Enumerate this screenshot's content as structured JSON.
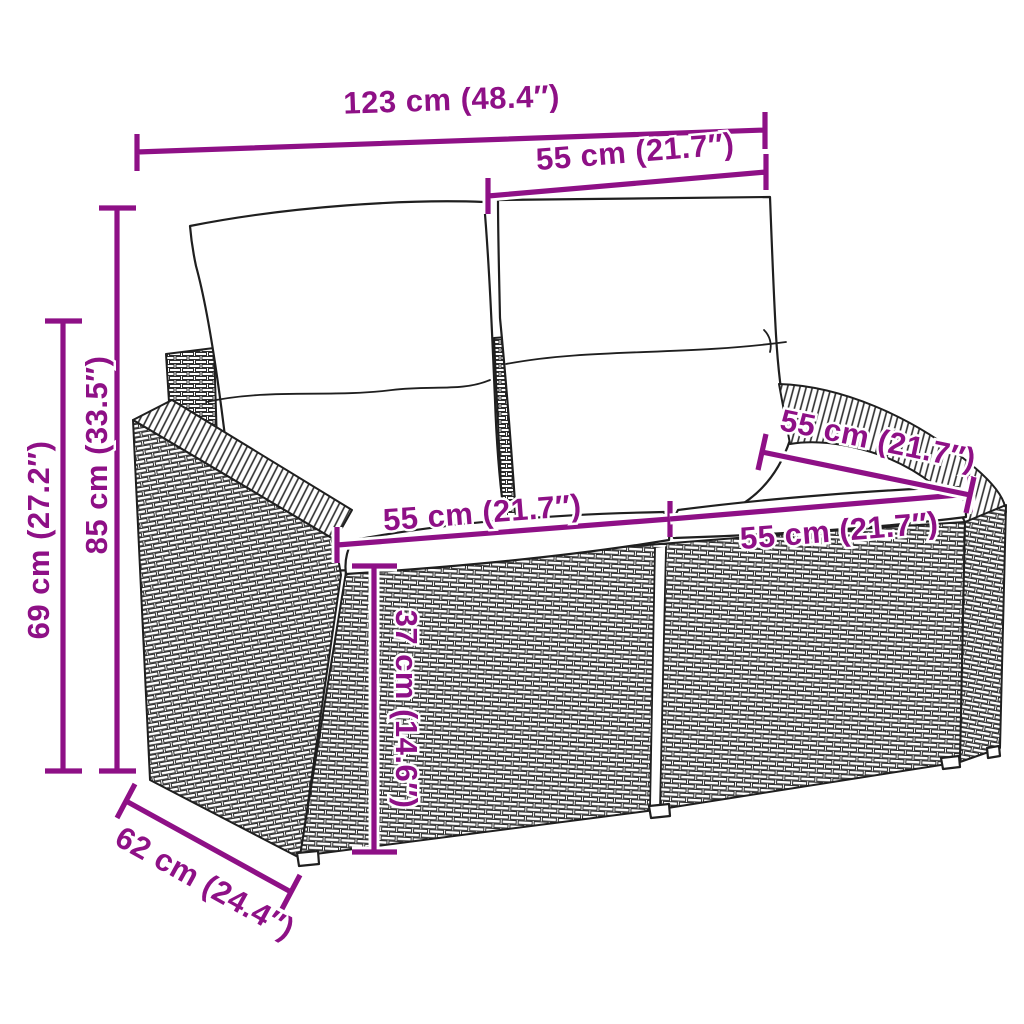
{
  "diagram": {
    "subject": "rattan-garden-loveseat-dimension-diagram",
    "accent_color": "#8E1086",
    "line_color": "#1f1f1f",
    "background_color": "#ffffff",
    "dimensions": [
      {
        "name": "overall-width",
        "label": "123 cm (48.4″)"
      },
      {
        "name": "back-cushion-width",
        "label": "55 cm (21.7″)"
      },
      {
        "name": "overall-height",
        "label": "85 cm (33.5″)"
      },
      {
        "name": "armrest-height",
        "label": "69 cm (27.2″)"
      },
      {
        "name": "seat-width-left",
        "label": "55 cm (21.7″)"
      },
      {
        "name": "seat-width-right",
        "label": "55 cm (21.7″)"
      },
      {
        "name": "seat-depth",
        "label": "55 cm (21.7″)"
      },
      {
        "name": "seat-height",
        "label": "37 cm (14.6″)"
      },
      {
        "name": "overall-depth",
        "label": "62 cm (24.4″)"
      }
    ]
  }
}
